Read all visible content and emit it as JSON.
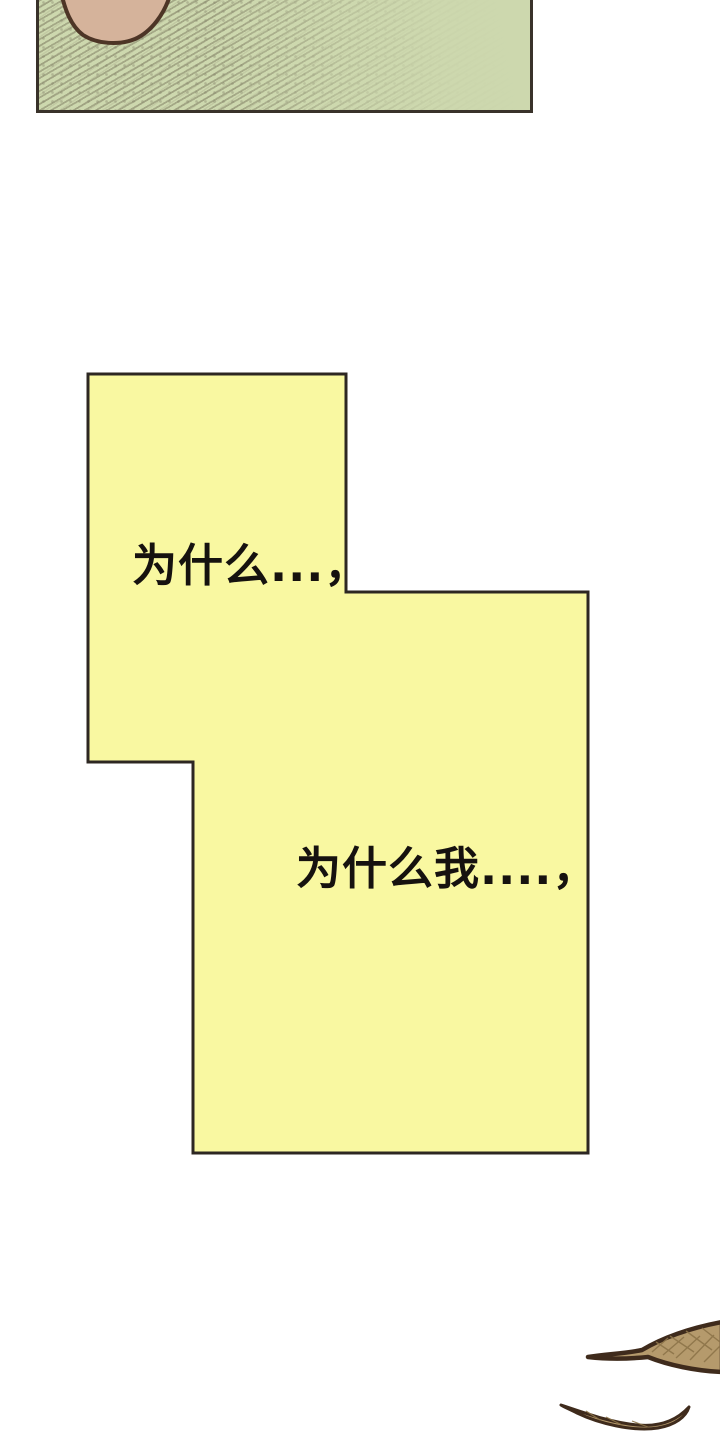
{
  "page": {
    "type": "comic-page",
    "background_color": "#ffffff"
  },
  "panel": {
    "description": "top panel cropped by page top edge, green hatched background with chin of a face",
    "border_color": "#39322a",
    "fill_color": "#cdd8ae",
    "hatch_color": "#8a8a6d",
    "skin": {
      "fill_color": "#d5b39b",
      "outline_color": "#4d3526"
    }
  },
  "speech_bubble": {
    "fill_color": "#f9f8a1",
    "border_color": "#2d2722",
    "lines": [
      {
        "text": "为什么...，"
      },
      {
        "text": "为什么我....，"
      }
    ]
  },
  "leaves": {
    "fill_color": "#b59a6c",
    "outline_color": "#3f2b1c",
    "hatch_color": "#8d7449"
  }
}
